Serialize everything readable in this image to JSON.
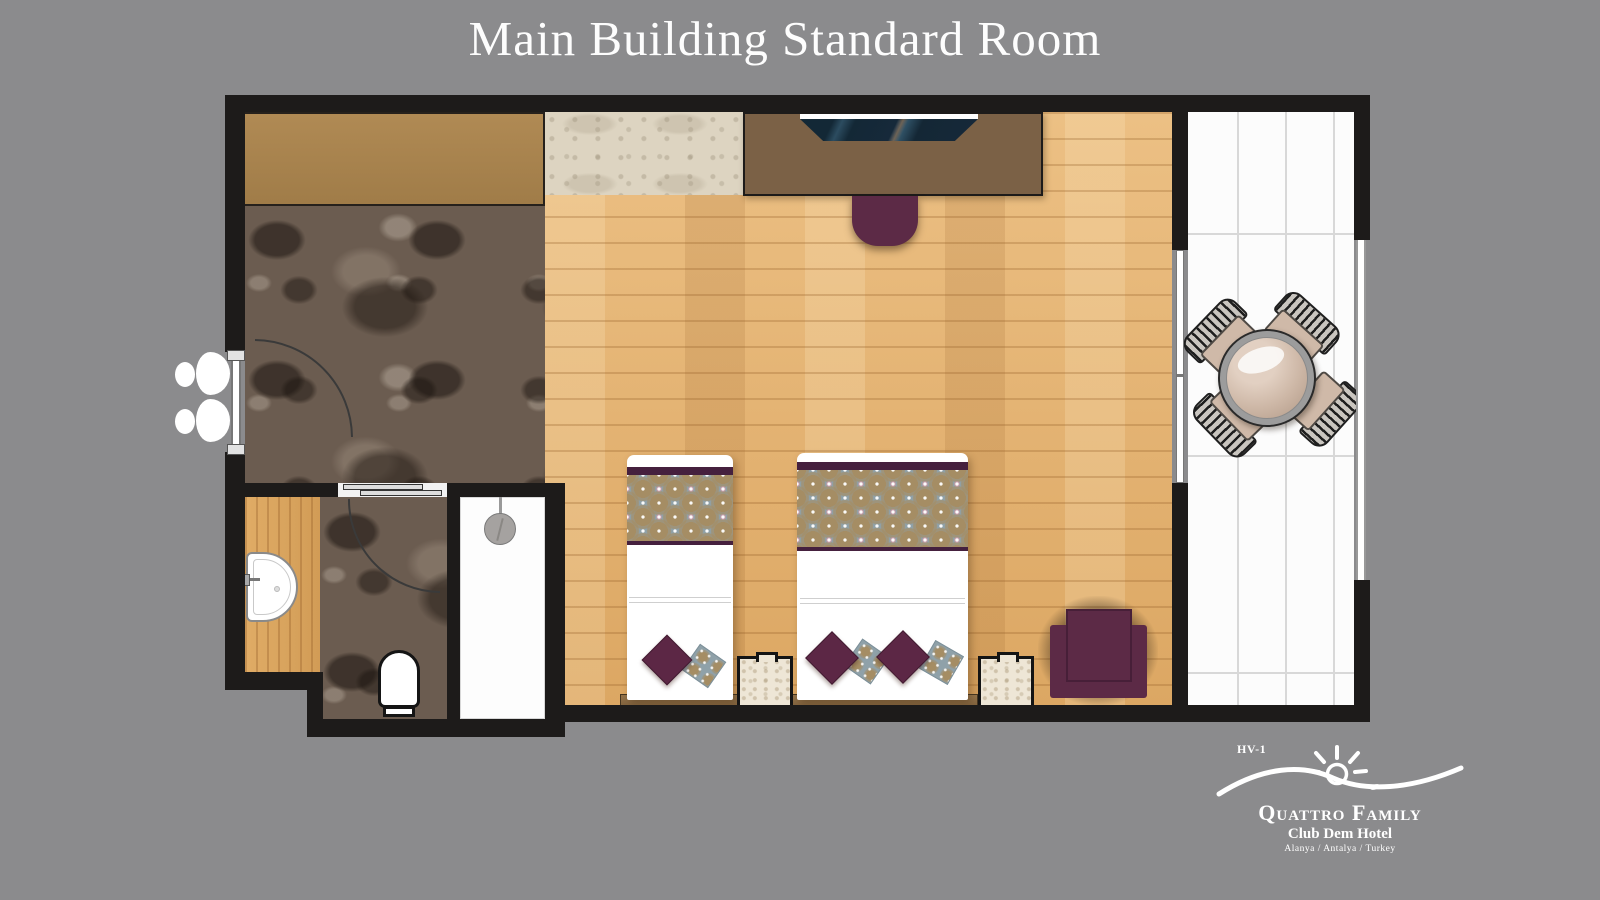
{
  "title": "Main Building Standard Room",
  "logo": {
    "code": "HV-1",
    "brand": "Quattro Family",
    "hotel": "Club Dem Hotel",
    "location": "Alanya / Antalya / Turkey"
  },
  "plan": {
    "rooms": [
      {
        "name": "entry-hall",
        "floor": "dark-marble"
      },
      {
        "name": "bathroom",
        "floor": "dark-marble"
      },
      {
        "name": "shower",
        "floor": "white"
      },
      {
        "name": "vanity",
        "floor": "light-wood"
      },
      {
        "name": "bedroom",
        "floor": "light-wood"
      },
      {
        "name": "balcony",
        "floor": "white-tile"
      }
    ],
    "furniture": [
      "wardrobe",
      "travertine-rug",
      "desk",
      "tv",
      "desk-chair",
      "single-bed",
      "double-bed",
      "nightstand-left",
      "nightstand-right",
      "armchair",
      "sink",
      "toilet",
      "shower-head",
      "slippers",
      "balcony-table",
      "balcony-chairs",
      "sliding-door",
      "entry-door",
      "bathroom-door"
    ]
  },
  "colors": {
    "background": "#8b8b8d",
    "wall": "#1d1b1a",
    "accent_plum": "#5c2745",
    "runner_blue": "#8fa1a9",
    "runner_tan": "#a58d64",
    "stripe_purple": "#45203e",
    "wood_floor": "#e4b274",
    "marble": "#6b5c50",
    "wardrobe_tan": "#a8834f",
    "desk_brown": "#7b6146",
    "tv_navy": "#16293a",
    "tile_white": "#fcfcfc",
    "title_white": "#fdfdfd"
  }
}
